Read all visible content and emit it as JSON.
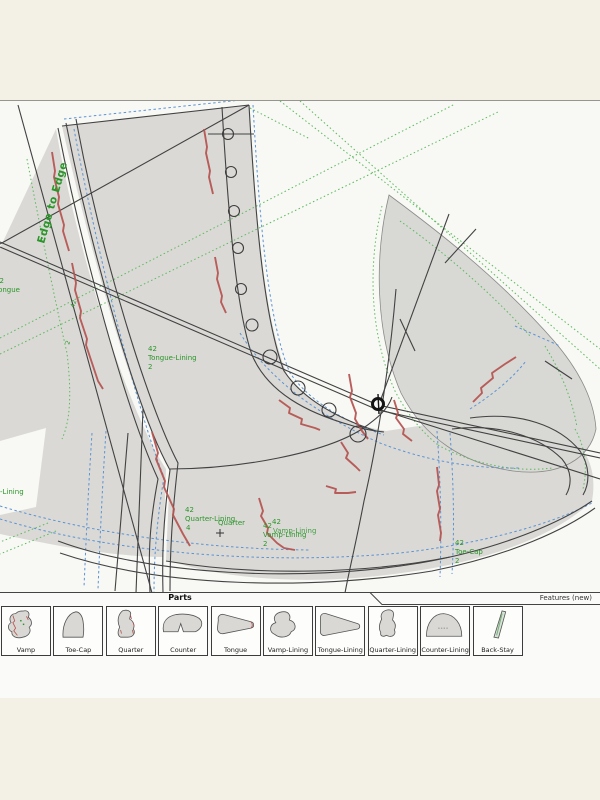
{
  "window": {
    "toolbar": {
      "parts_label": "Parts",
      "features_label": "Features (new)"
    }
  },
  "drawing": {
    "annotations": {
      "edge_to_edge": "Edge to Edge",
      "lining_partial": "-Lining",
      "tongue": {
        "num": "42",
        "name": "Tongue",
        "qty": "2"
      },
      "tongue_lining": {
        "num": "42",
        "name": "Tongue-Lining",
        "qty": "2"
      },
      "quarter_lining": {
        "num": "42",
        "name": "Quarter-Lining",
        "qty": "4"
      },
      "quarter_ref": "Quarter",
      "vamp_lining": {
        "num": "42",
        "num2": "42",
        "name": "Vamp-Lining",
        "name2": "Vamp-Lining",
        "qty": "2"
      },
      "toe_cap": {
        "num": "42",
        "name": "Toe-Cap",
        "qty": "2"
      },
      "tick_42": "42",
      "tick_2": "2"
    },
    "colors": {
      "pattern_fill": "#dad9d6",
      "outline": "#424242",
      "stitch_red": "#b5524e",
      "allowance_blue": "#5b93d4",
      "style_green": "#5cba5c",
      "label_green": "#2a9528"
    }
  },
  "parts_tray": {
    "items": [
      {
        "key": "vamp",
        "label": "Vamp"
      },
      {
        "key": "toe_cap",
        "label": "Toe-Cap"
      },
      {
        "key": "quarter",
        "label": "Quarter"
      },
      {
        "key": "counter",
        "label": "Counter"
      },
      {
        "key": "tongue",
        "label": "Tongue"
      },
      {
        "key": "vamp_lining",
        "label": "Vamp-Lining"
      },
      {
        "key": "tongue_lining",
        "label": "Tongue-Lining"
      },
      {
        "key": "quarter_lining",
        "label": "Quarter-Lining"
      },
      {
        "key": "counter_lining",
        "label": "Counter-Lining"
      },
      {
        "key": "back_stay",
        "label": "Back-Stay"
      }
    ]
  }
}
